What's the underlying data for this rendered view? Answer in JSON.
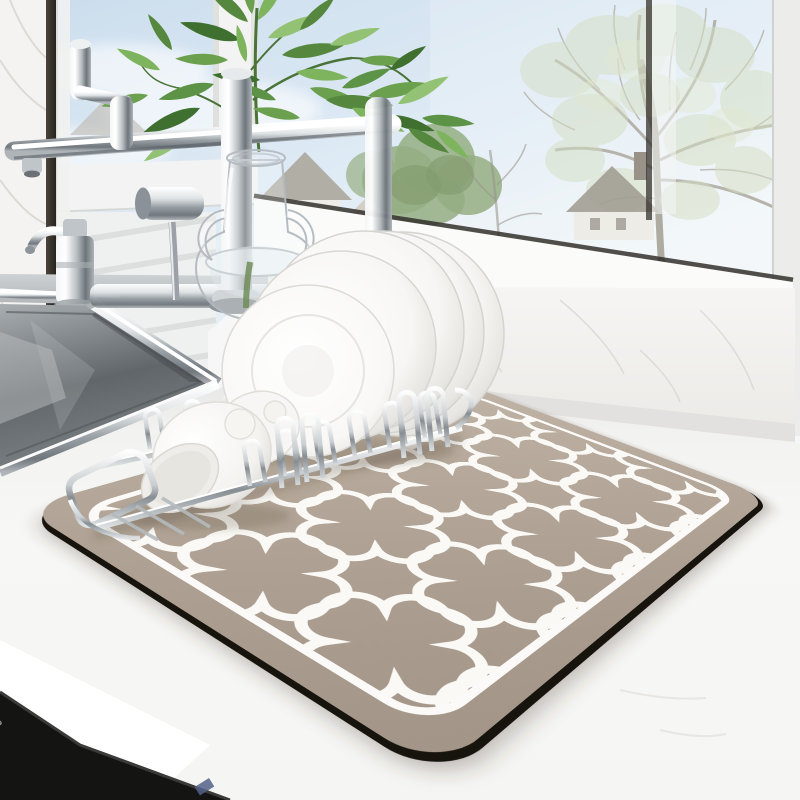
{
  "meta": {
    "type": "product-photo",
    "subject": "Dish drying mat on kitchen counter",
    "canvas": {
      "width": 800,
      "height": 800
    }
  },
  "appliance": {
    "brand_text": "SOURCE | WAKE"
  },
  "scene": {
    "setting": "bright kitchen counter in front of a window with a spring tree view",
    "objects": [
      {
        "name": "drying-mat",
        "description": "taupe rounded-rectangle drying mat with white Moroccan quatrefoil trellis pattern, white inner border line and black rubber edge"
      },
      {
        "name": "dish-rack",
        "description": "chrome wire dish rack sitting on the mat"
      },
      {
        "name": "plates",
        "description": "stack of white dinner plates leaning in the rack"
      },
      {
        "name": "bowls",
        "description": "two white bowls tipped to drain at the left end of the rack"
      },
      {
        "name": "faucet",
        "description": "modern chrome kitchen faucet with horizontal spout bar and docked spray head"
      },
      {
        "name": "soap-dispenser",
        "description": "chrome counter soap dispenser"
      },
      {
        "name": "sink",
        "description": "stainless steel inset sink basin, lower left"
      },
      {
        "name": "vase",
        "description": "clear glass vase with two loop handles, water and ribbed foot"
      },
      {
        "name": "plant",
        "description": "green leafy stems rising from the vase"
      },
      {
        "name": "window",
        "description": "white-framed window showing a large hazy tree, green bush, gabled houses and blue sky; venetian blind on left pane"
      },
      {
        "name": "windowsill",
        "description": "white marble windowsill and backsplash"
      },
      {
        "name": "counter",
        "description": "white countertop with bright front edge"
      },
      {
        "name": "appliance",
        "description": "black appliance front in lower-left corner with mirrored brand text"
      }
    ]
  },
  "palette": {
    "mat_base": "#b3a698",
    "mat_light": "#c0b4a6",
    "mat_dark": "#a29587",
    "mat_pattern_line": "#faf9f6",
    "mat_edge_black": "#17130d",
    "counter_white": "#f6f6f5",
    "sky_blue": "#c6daec",
    "foliage_green": "#6ba04e",
    "hazy_tree_green": "#c5d3ab",
    "chrome_light": "#f4f6f7",
    "chrome_dark": "#6d747a",
    "sink_basin_gray": "#61666a",
    "marble_vein": "#d5d3cf",
    "appliance_black": "#141413"
  }
}
